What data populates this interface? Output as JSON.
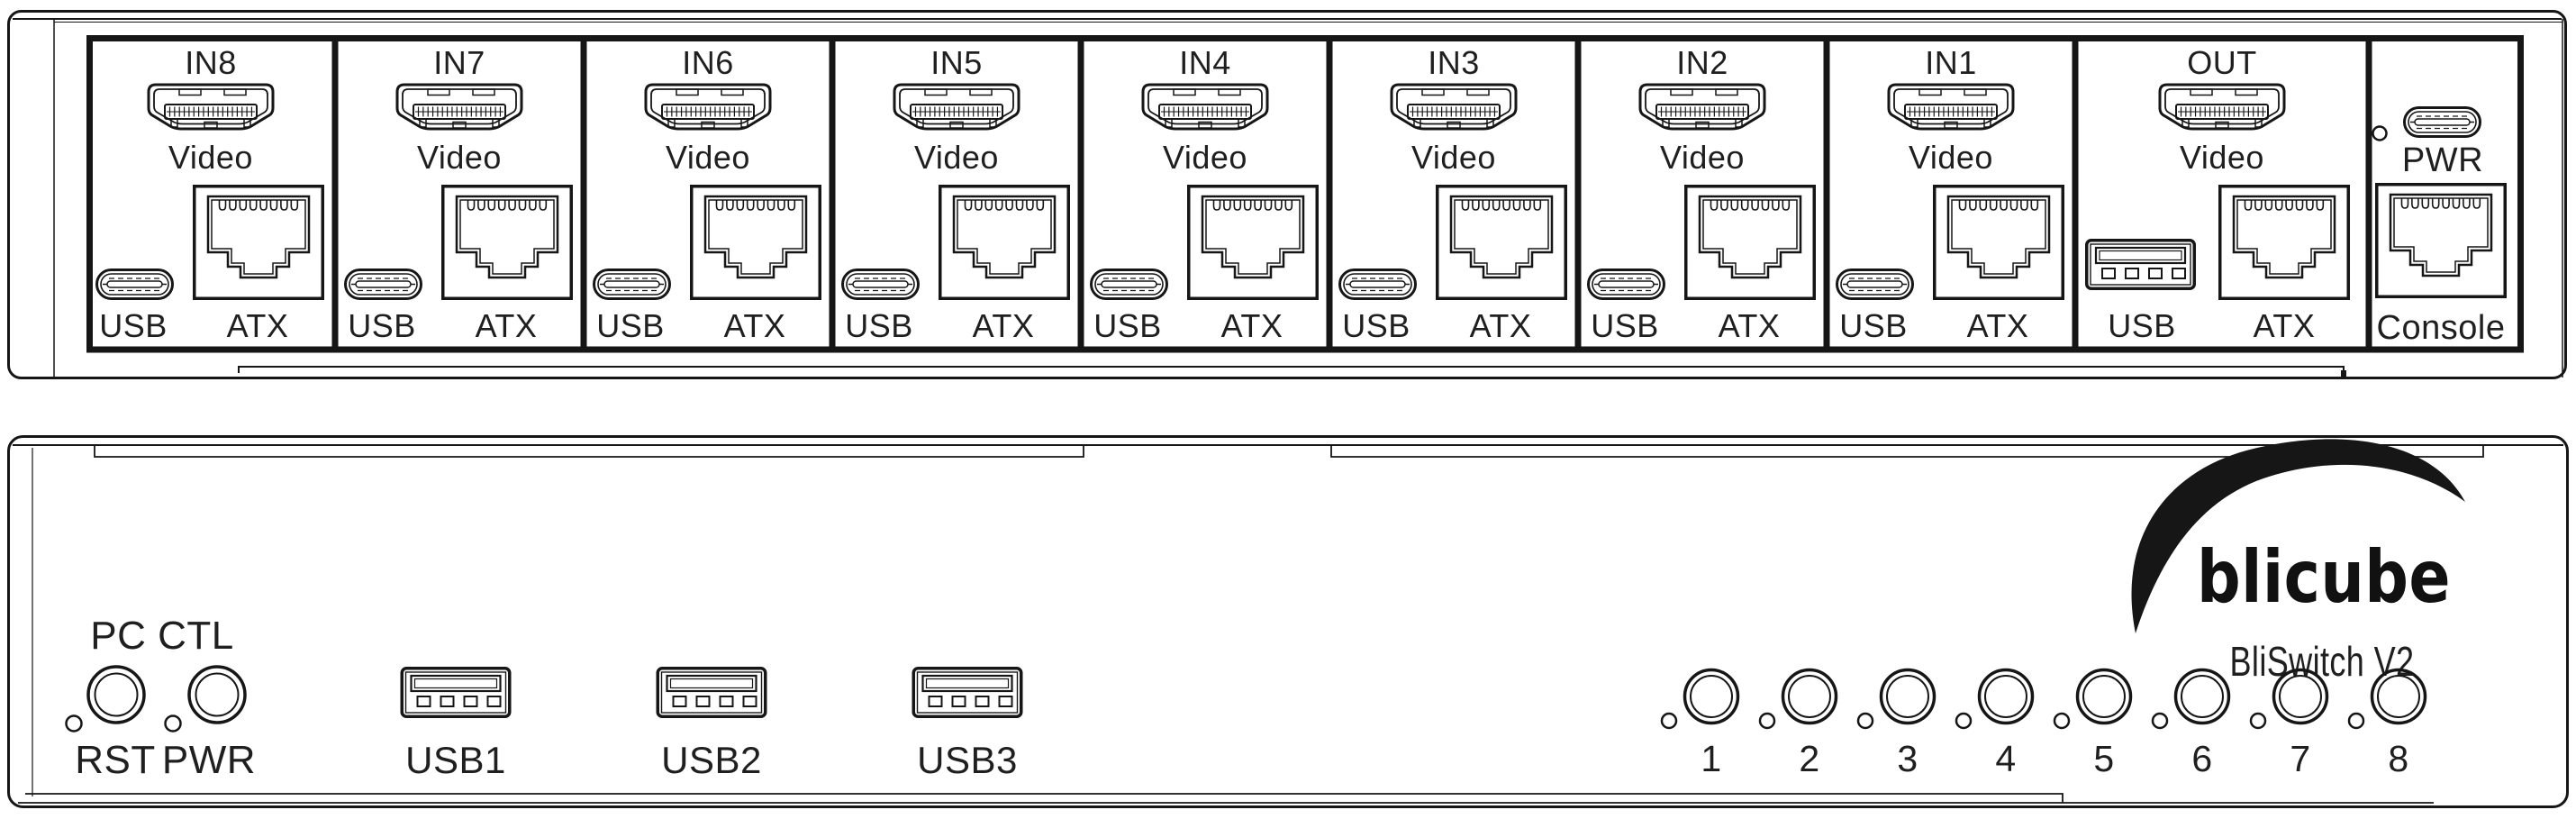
{
  "colors": {
    "line": "#161616",
    "background": "#ffffff"
  },
  "icons": {
    "hdmi": "hdmi-port-icon",
    "rj45": "rj45-port-icon",
    "usb_c": "usb-c-port-icon",
    "usb_a": "usb-a-port-icon",
    "led": "led-indicator-dot",
    "push_button": "push-button"
  },
  "rear_panel": {
    "inputs": [
      {
        "label": "IN8",
        "video_label": "Video",
        "usb_label": "USB",
        "atx_label": "ATX"
      },
      {
        "label": "IN7",
        "video_label": "Video",
        "usb_label": "USB",
        "atx_label": "ATX"
      },
      {
        "label": "IN6",
        "video_label": "Video",
        "usb_label": "USB",
        "atx_label": "ATX"
      },
      {
        "label": "IN5",
        "video_label": "Video",
        "usb_label": "USB",
        "atx_label": "ATX"
      },
      {
        "label": "IN4",
        "video_label": "Video",
        "usb_label": "USB",
        "atx_label": "ATX"
      },
      {
        "label": "IN3",
        "video_label": "Video",
        "usb_label": "USB",
        "atx_label": "ATX"
      },
      {
        "label": "IN2",
        "video_label": "Video",
        "usb_label": "USB",
        "atx_label": "ATX"
      },
      {
        "label": "IN1",
        "video_label": "Video",
        "usb_label": "USB",
        "atx_label": "ATX"
      }
    ],
    "output_section": {
      "label": "OUT",
      "video_label": "Video",
      "usb_label": "USB",
      "atx_label": "ATX"
    },
    "power_console_section": {
      "power_label": "PWR",
      "console_label": "Console"
    }
  },
  "front_panel": {
    "pc_ctl_group": {
      "label": "PC CTL",
      "reset_label": "RST",
      "power_label": "PWR"
    },
    "usb_ports": [
      {
        "label": "USB1"
      },
      {
        "label": "USB2"
      },
      {
        "label": "USB3"
      }
    ],
    "channel_buttons": [
      {
        "label": "1"
      },
      {
        "label": "2"
      },
      {
        "label": "3"
      },
      {
        "label": "4"
      },
      {
        "label": "5"
      },
      {
        "label": "6"
      },
      {
        "label": "7"
      },
      {
        "label": "8"
      }
    ],
    "brand": "blicube",
    "model": "BliSwitch V2"
  }
}
